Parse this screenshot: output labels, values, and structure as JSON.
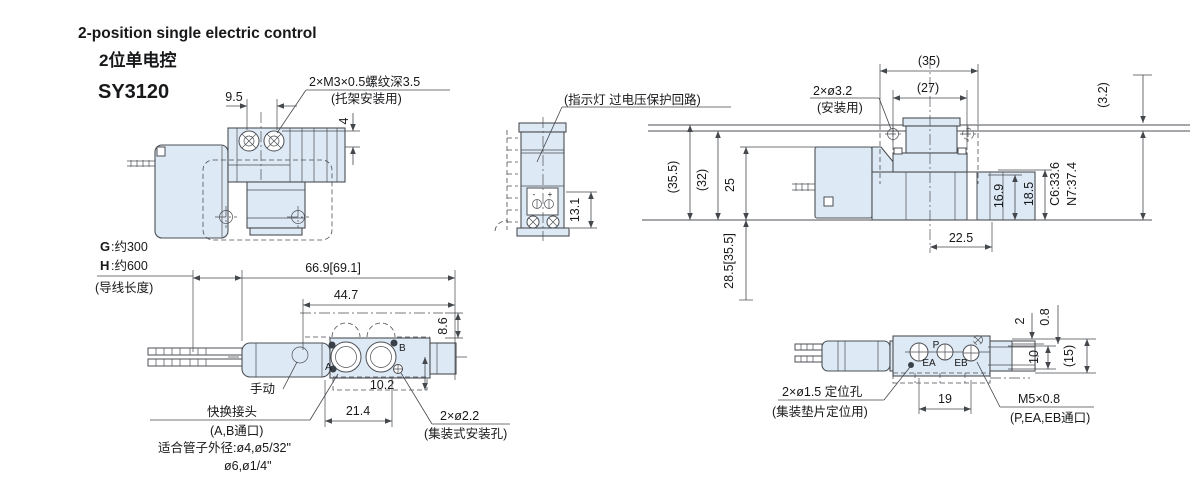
{
  "title": {
    "en": "2-position single electric control",
    "cn": "2位单电控",
    "model": "SY3120"
  },
  "lead": {
    "g": "G",
    "gv": ":约300",
    "h": "H",
    "hv": ":约600",
    "note": "(导线长度)"
  },
  "top_left": {
    "d95": "9.5",
    "thread": "2×M3×0.5螺纹深3.5",
    "thread_note": "(托架安装用)",
    "d4": "4"
  },
  "front": {
    "note": "(指示灯 过电压保护回路)",
    "d131": "13.1",
    "minus": "-",
    "plus": "+"
  },
  "top_right": {
    "d35": "(35)",
    "d27": "(27)",
    "hole": "2×ø3.2",
    "hole_note": "(安装用)",
    "d3_2": "(3.2)",
    "d35_5": "(35.5)",
    "d32": "(32)",
    "d25": "25",
    "d28_5": "28.5[35.5]",
    "d22_5": "22.5",
    "d16_9": "16.9",
    "d18_5": "18.5",
    "c6": "C6:33.6",
    "n7": "N7:37.4"
  },
  "bottom_left": {
    "d66_9": "66.9[69.1]",
    "d44_7": "44.7",
    "d8_6": "8.6",
    "manual": "手动",
    "d10_2": "10.2",
    "d21_4": "21.4",
    "fitting": "快换接头",
    "fitting_note": "(A,B通口)",
    "tube1": "适合管子外径:ø4,ø5/32\"",
    "tube2": "ø6,ø1/4\"",
    "hole": "2×ø2.2",
    "hole_note": "(集装式安装孔)",
    "port_a": "A",
    "port_b": "B"
  },
  "bottom_right": {
    "d2": "2",
    "d0_8": "0.8",
    "d10": "10",
    "d15": "(15)",
    "d19": "19",
    "pin": "2×ø1.5 定位孔",
    "pin_note": "(集装垫片定位用)",
    "thread": "M5×0.8",
    "thread_note": "(P,EA,EB通口)",
    "port_p": "P",
    "port_ea": "EA",
    "port_eb": "EB"
  },
  "colors": {
    "body_fill": "#dde9f5",
    "line": "#4c4f54",
    "text": "#17181a"
  }
}
